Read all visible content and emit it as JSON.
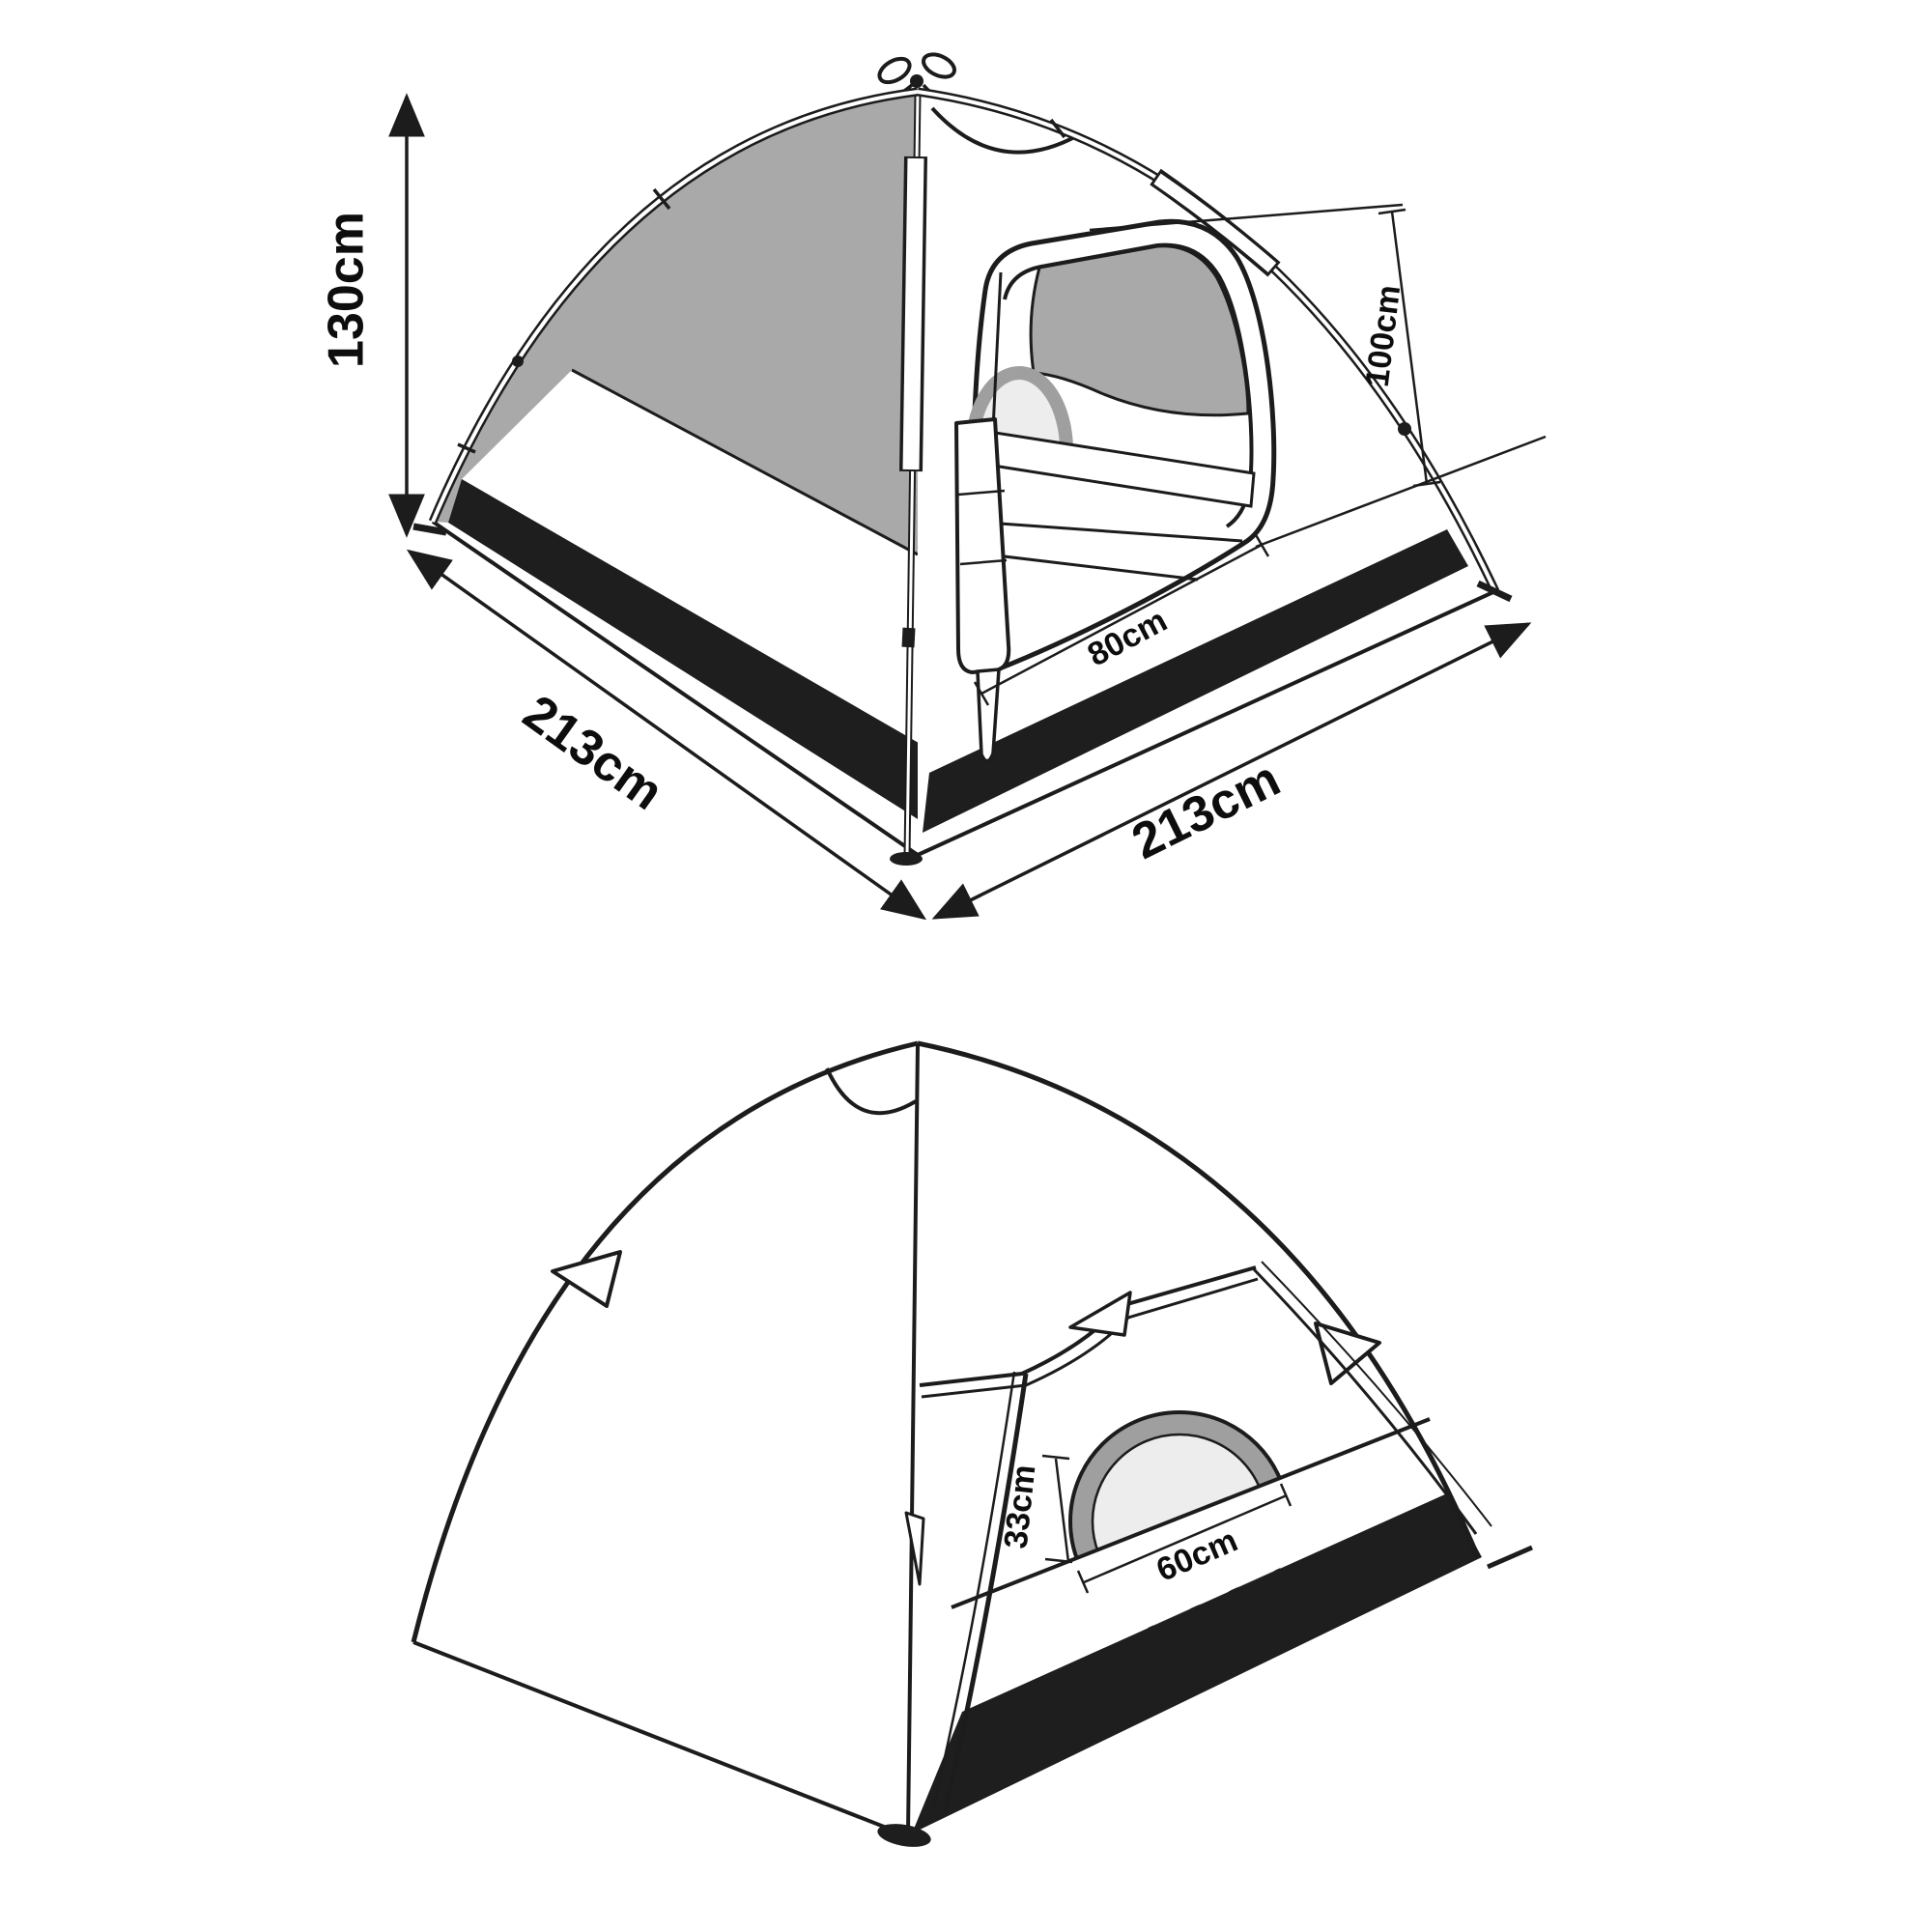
{
  "figures": {
    "perspective_view": {
      "name": "tent perspective view",
      "dimensions": {
        "height": "130cm",
        "width": "213cm",
        "depth": "213cm",
        "door_height": "100cm",
        "door_width": "80cm"
      }
    },
    "rear_view": {
      "name": "tent rear view",
      "dimensions": {
        "window_height": "33cm",
        "window_width": "60cm"
      }
    }
  },
  "colors": {
    "line": "#1c1c1c",
    "mesh_gray": "#a9a9a9",
    "ground_strip_black": "#1e1e1e",
    "window_ring_gray": "#9f9f9f",
    "window_glass": "#ededed",
    "background": "#ffffff"
  }
}
